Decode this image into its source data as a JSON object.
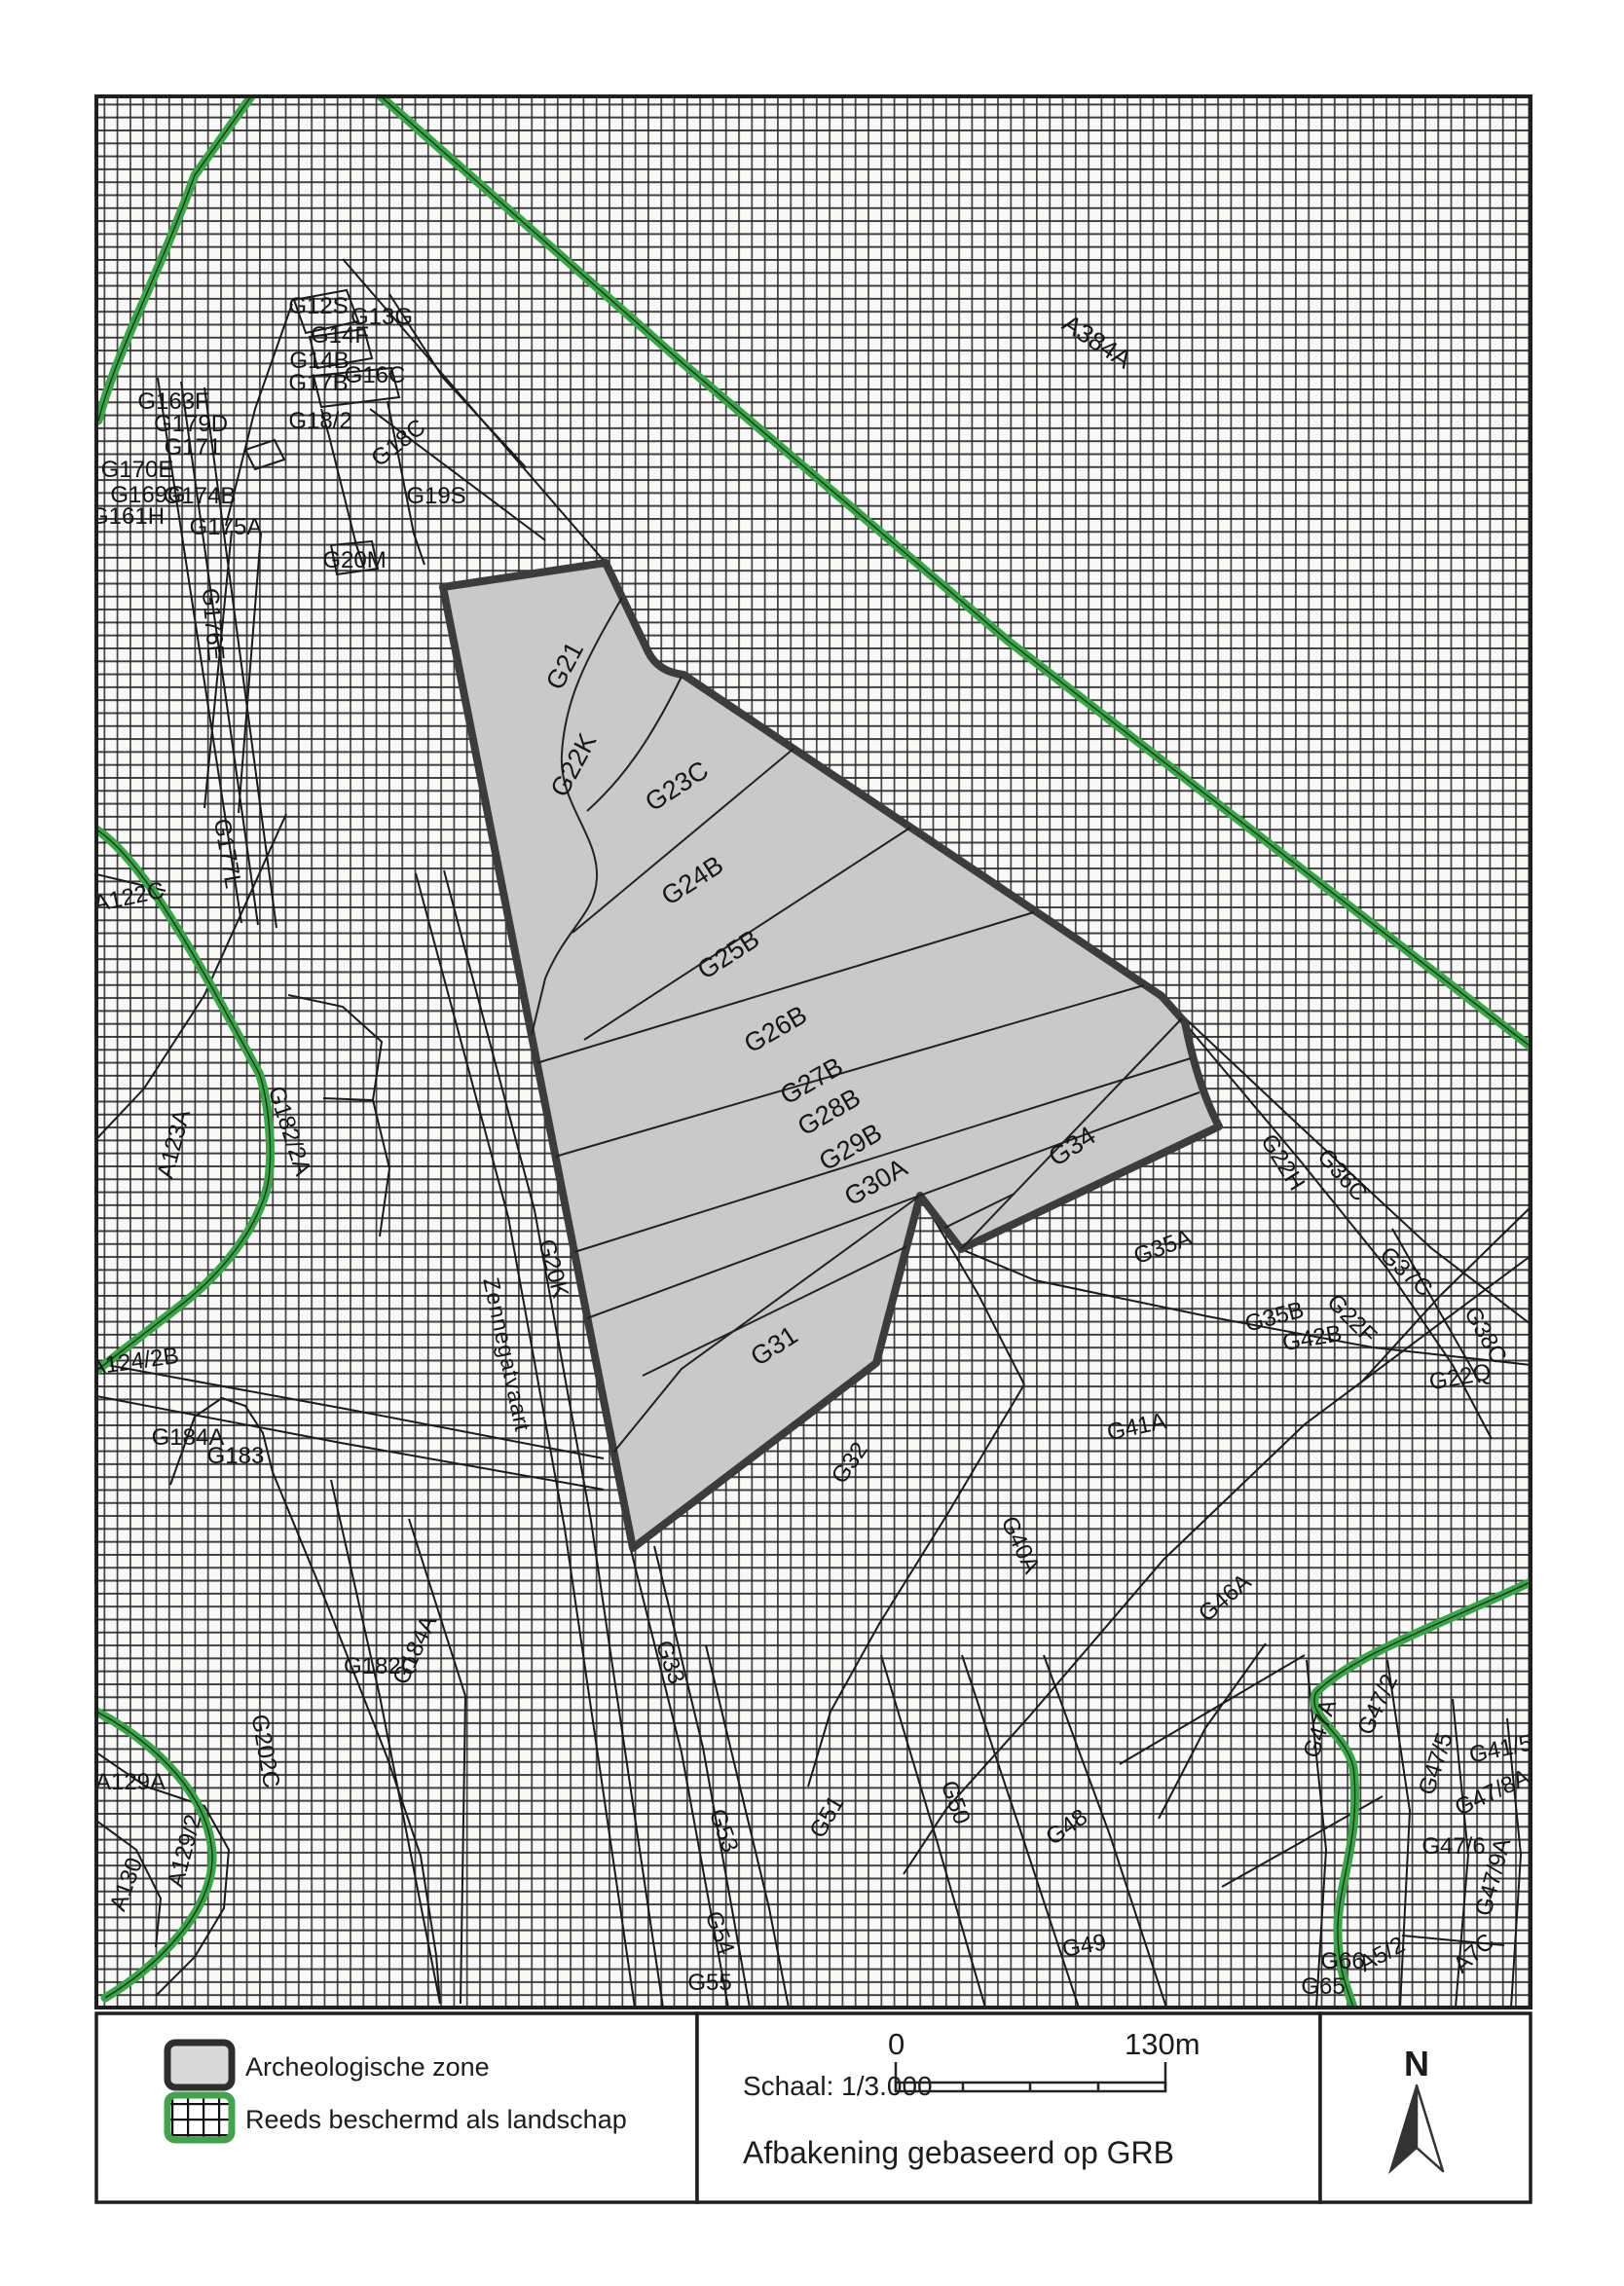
{
  "colors": {
    "accent_green": "#3da44b",
    "zone_fill": "#c9c9c9",
    "zone_border": "#3c3c3c",
    "hatch_line": "#262626",
    "parcel_line": "#1b1b1b",
    "map_background": "#f8f8f6",
    "ink": "#1c1c1c"
  },
  "legend": {
    "items": [
      {
        "label": "Archeologische zone",
        "swatch": "gray-zone-swatch"
      },
      {
        "label": "Reeds beschermd als landschap",
        "swatch": "green-hatch-swatch"
      }
    ]
  },
  "scale_panel": {
    "scale_label": "Schaal: 1/3.000",
    "bar_start": "0",
    "bar_end": "130m",
    "note": "Afbakening gebaseerd op GRB"
  },
  "north_panel": {
    "label": "N"
  },
  "map": {
    "street_name": "Zennegatvaart",
    "labels": [
      [
        "G21",
        588,
        688,
        -62,
        27
      ],
      [
        "G22K",
        597,
        790,
        -62,
        27
      ],
      [
        "G23C",
        700,
        815,
        -33,
        27
      ],
      [
        "G24B",
        716,
        912,
        -33,
        27
      ],
      [
        "G25B",
        753,
        988,
        -33,
        27
      ],
      [
        "G26B",
        801,
        1065,
        -30,
        27
      ],
      [
        "G27B",
        838,
        1118,
        -30,
        27
      ],
      [
        "G28B",
        856,
        1150,
        -30,
        27
      ],
      [
        "G29B",
        878,
        1186,
        -30,
        27
      ],
      [
        "G30A",
        904,
        1222,
        -30,
        27
      ],
      [
        "G31",
        800,
        1390,
        -33,
        27
      ],
      [
        "G34",
        1106,
        1185,
        -33,
        27
      ],
      [
        "G12S",
        327,
        322,
        0,
        24
      ],
      [
        "G13G",
        392,
        333,
        0,
        24
      ],
      [
        "G14F",
        349,
        352,
        0,
        24
      ],
      [
        "G14B",
        328,
        378,
        0,
        24
      ],
      [
        "G17B",
        327,
        401,
        0,
        24
      ],
      [
        "G16C",
        385,
        393,
        0,
        24
      ],
      [
        "G18/2",
        329,
        440,
        0,
        24
      ],
      [
        "G18C",
        414,
        461,
        -38,
        24
      ],
      [
        "G19S",
        448,
        517,
        0,
        24
      ],
      [
        "G20M",
        364,
        583,
        0,
        24
      ],
      [
        "G163F",
        178,
        420,
        0,
        24
      ],
      [
        "G179D",
        196,
        443,
        0,
        24
      ],
      [
        "G171",
        198,
        467,
        0,
        24
      ],
      [
        "G170E",
        141,
        490,
        0,
        24
      ],
      [
        "G169G",
        152,
        516,
        0,
        24
      ],
      [
        "G174B",
        205,
        517,
        0,
        24
      ],
      [
        "G161H",
        131,
        538,
        0,
        24
      ],
      [
        "G175A",
        232,
        549,
        0,
        24
      ],
      [
        "G176E",
        211,
        642,
        85,
        24
      ],
      [
        "A384A",
        1122,
        358,
        33,
        26
      ],
      [
        "G177L",
        226,
        878,
        80,
        24
      ],
      [
        "A122C",
        134,
        929,
        -12,
        24
      ],
      [
        "A123A",
        186,
        1177,
        -75,
        24
      ],
      [
        "G182/2A",
        290,
        1164,
        72,
        24
      ],
      [
        "A124/2B",
        139,
        1406,
        -8,
        24
      ],
      [
        "G184A",
        193,
        1484,
        0,
        24
      ],
      [
        "G183",
        242,
        1503,
        0,
        24
      ],
      [
        "G202C",
        265,
        1800,
        80,
        24
      ],
      [
        "A129A",
        134,
        1838,
        0,
        24
      ],
      [
        "A130",
        137,
        1938,
        -70,
        24
      ],
      [
        "A129/2",
        197,
        1903,
        -75,
        24
      ],
      [
        "G182C",
        391,
        1719,
        0,
        24
      ],
      [
        "G184A",
        433,
        1698,
        -65,
        24
      ],
      [
        "Zennegatvaart",
        513,
        1393,
        78,
        23
      ],
      [
        "G20K",
        561,
        1305,
        75,
        24
      ],
      [
        "G33",
        681,
        1710,
        70,
        24
      ],
      [
        "G53",
        736,
        1883,
        70,
        24
      ],
      [
        "G54",
        732,
        1988,
        70,
        24
      ],
      [
        "G55",
        729,
        2044,
        0,
        24
      ],
      [
        "G51",
        856,
        1870,
        -60,
        24
      ],
      [
        "G50",
        974,
        1854,
        70,
        24
      ],
      [
        "G48",
        1100,
        1883,
        -35,
        24
      ],
      [
        "G49",
        1115,
        2006,
        -10,
        24
      ],
      [
        "G32",
        879,
        1507,
        -55,
        24
      ],
      [
        "G41A",
        1169,
        1473,
        -12,
        24
      ],
      [
        "G40A",
        1041,
        1590,
        65,
        24
      ],
      [
        "G46A",
        1263,
        1647,
        -40,
        24
      ],
      [
        "G35A",
        1197,
        1288,
        -20,
        24
      ],
      [
        "G22H",
        1311,
        1198,
        58,
        24
      ],
      [
        "G36C",
        1373,
        1212,
        48,
        24
      ],
      [
        "G37C",
        1439,
        1312,
        42,
        24
      ],
      [
        "G35B",
        1311,
        1360,
        -15,
        24
      ],
      [
        "G22F",
        1383,
        1360,
        45,
        24
      ],
      [
        "G42B",
        1349,
        1382,
        -10,
        24
      ],
      [
        "G38C",
        1519,
        1375,
        60,
        24
      ],
      [
        "G22Q",
        1501,
        1422,
        -10,
        24
      ],
      [
        "G47A",
        1363,
        1778,
        -72,
        24
      ],
      [
        "G47/2",
        1422,
        1754,
        -65,
        24
      ],
      [
        "G47/5",
        1482,
        1814,
        -72,
        24
      ],
      [
        "G41/5",
        1543,
        1804,
        -12,
        24
      ],
      [
        "G47/8A",
        1536,
        1848,
        -25,
        24
      ],
      [
        "G47/6",
        1493,
        1904,
        0,
        24
      ],
      [
        "G47/9A",
        1541,
        1930,
        -75,
        24
      ],
      [
        "G66",
        1379,
        2022,
        0,
        24
      ],
      [
        "G65",
        1359,
        2048,
        0,
        24
      ],
      [
        "A5/2",
        1423,
        2014,
        -28,
        24
      ],
      [
        "A7C",
        1519,
        2012,
        -42,
        24
      ]
    ]
  }
}
